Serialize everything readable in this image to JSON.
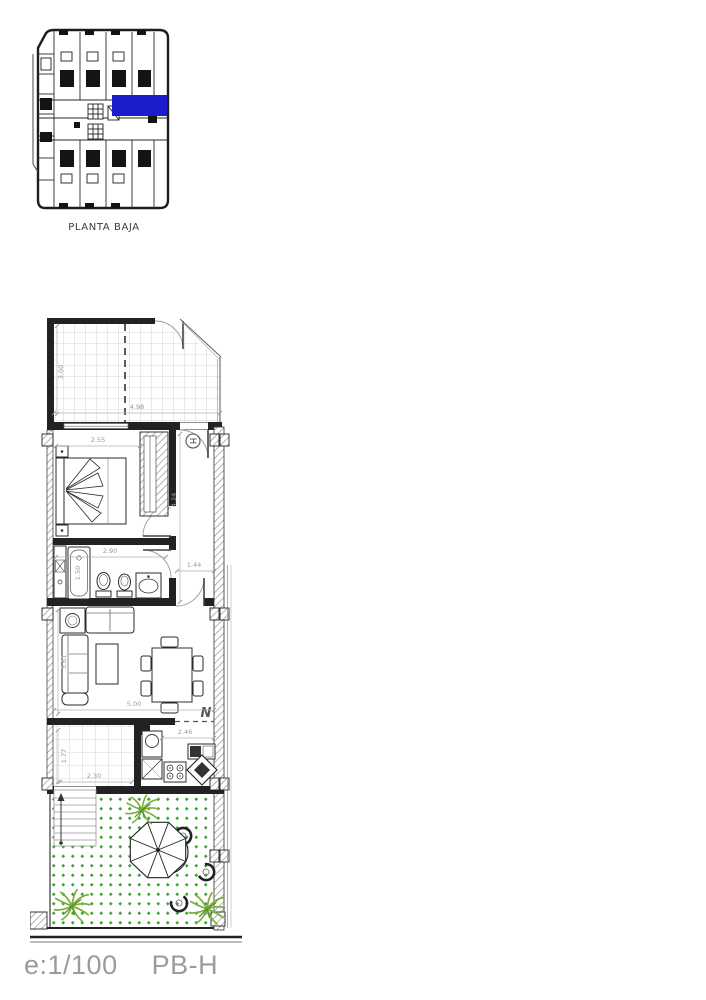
{
  "colors": {
    "highlight": "#1c1ccd",
    "wall": "#222222",
    "hatch_gray": "#8c8c8c",
    "tile_gray": "#cccccc",
    "dim_text": "#9a9a9a",
    "garden_green": "#3aa335",
    "plant_green": "#7fae3c",
    "footer_text": "#9b9b9b"
  },
  "key_plan": {
    "caption": "PLANTA BAJA"
  },
  "main_plan": {
    "entrance_label": "H",
    "north_label": "N",
    "dimensions": {
      "terrace_depth": "3.00",
      "terrace_width": "4.98",
      "bedroom_width": "2.55",
      "hall_length": "4.24",
      "bathroom_width": "2.90",
      "bathtub_length": "1.50",
      "hall_width": "1.44",
      "living_depth": "3.61",
      "living_width": "5.00",
      "kitchen_width": "2.46",
      "patio_depth": "1.77",
      "patio_width": "2.30"
    }
  },
  "footer": {
    "scale_label": "e:1/100",
    "plan_code": "PB-H"
  }
}
